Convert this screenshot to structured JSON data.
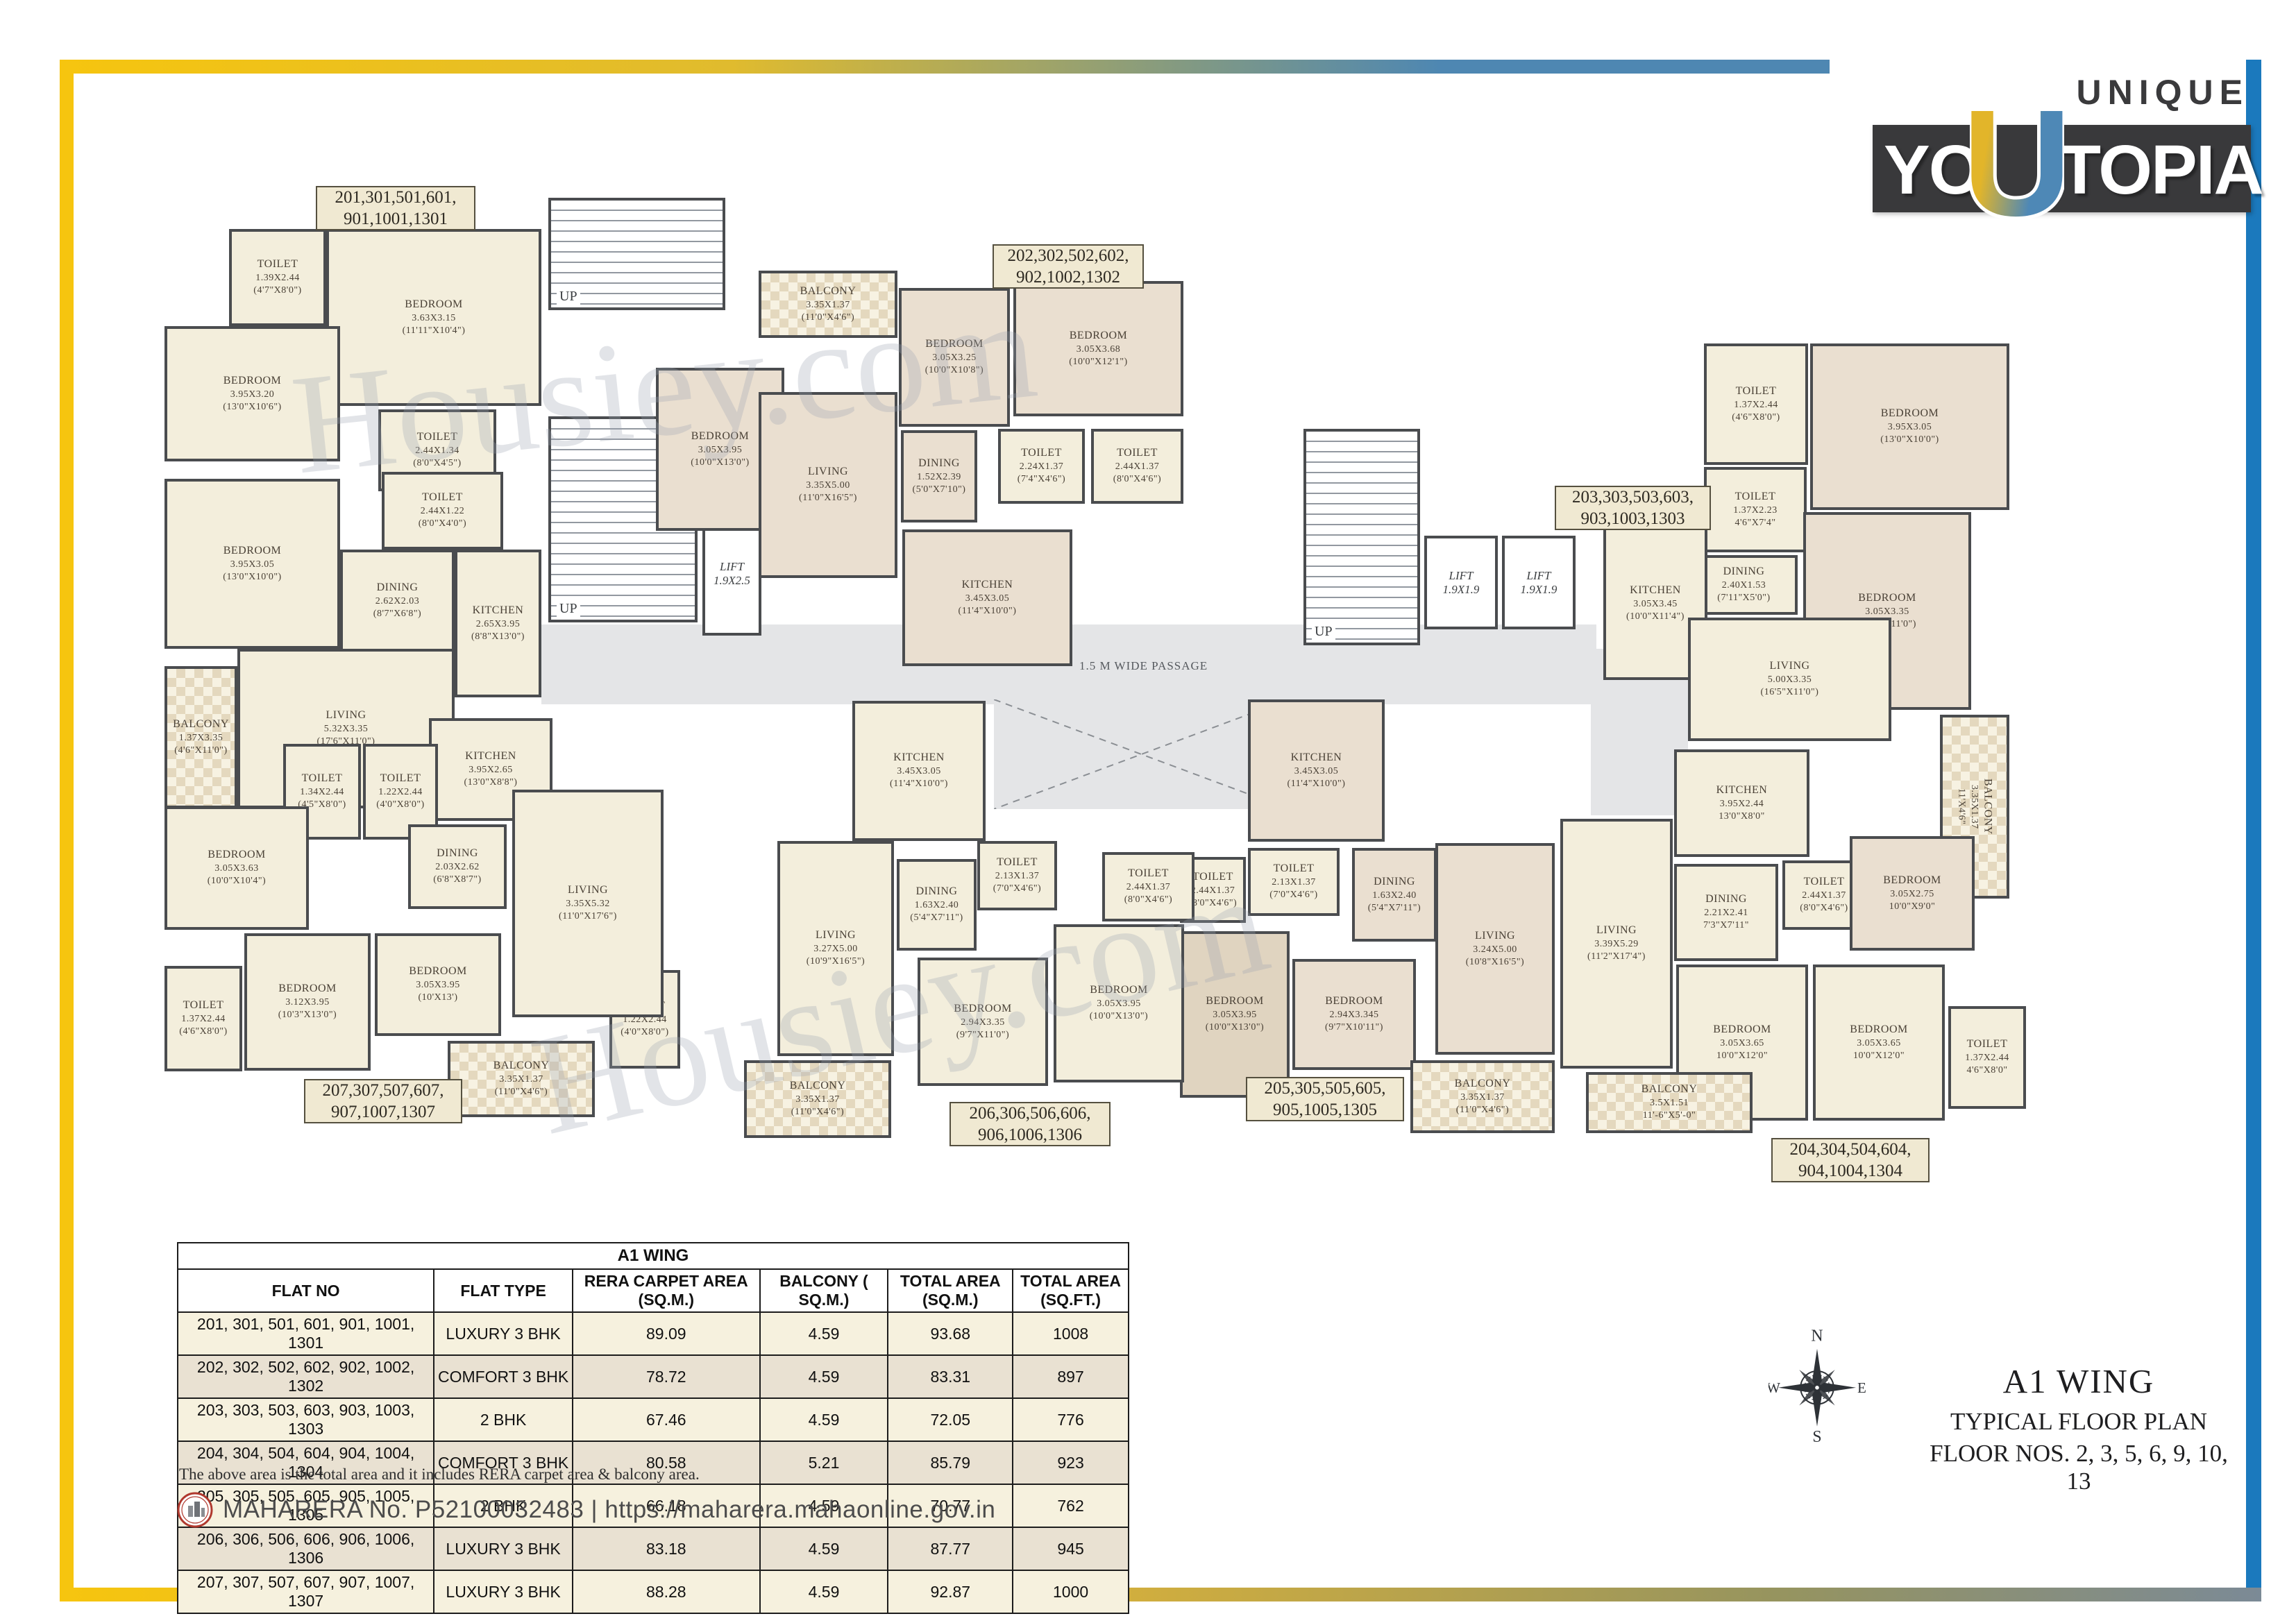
{
  "brand": {
    "unique": "UNIQUE",
    "yo": "YO",
    "u": "U",
    "topia": "TOPIA"
  },
  "plan": {
    "watermark": "Housiey.com",
    "passage": "1.5 M WIDE PASSAGE",
    "up": "UP",
    "lifts": [
      {
        "name": "LIFT",
        "size": "1.9X2.5"
      },
      {
        "name": "LIFT",
        "size": "1.9X1.9"
      },
      {
        "name": "LIFT",
        "size": "1.9X1.9"
      }
    ],
    "apts": [
      {
        "id": "201",
        "label": [
          "201,301,501,601,",
          "901,1001,1301"
        ],
        "rooms": [
          {
            "n": "TOILET",
            "m": "1.39X2.44",
            "f": "(4'7\"X8'0\")"
          },
          {
            "n": "BEDROOM",
            "m": "3.63X3.15",
            "f": "(11'11\"X10'4\")"
          },
          {
            "n": "BEDROOM",
            "m": "3.95X3.20",
            "f": "(13'0\"X10'6\")"
          },
          {
            "n": "TOILET",
            "m": "2.44X1.34",
            "f": "(8'0\"X4'5\")"
          },
          {
            "n": "TOILET",
            "m": "2.44X1.22",
            "f": "(8'0\"X4'0\")"
          },
          {
            "n": "BEDROOM",
            "m": "3.95X3.05",
            "f": "(13'0\"X10'0\")"
          },
          {
            "n": "DINING",
            "m": "2.62X2.03",
            "f": "(8'7\"X6'8\")"
          },
          {
            "n": "KITCHEN",
            "m": "2.65X3.95",
            "f": "(8'8\"X13'0\")"
          },
          {
            "n": "BALCONY",
            "m": "1.37X3.35",
            "f": "(4'6\"X11'0\")"
          },
          {
            "n": "LIVING",
            "m": "5.32X3.35",
            "f": "(17'6\"X11'0\")"
          }
        ]
      },
      {
        "id": "202",
        "label": [
          "202,302,502,602,",
          "902,1002,1302"
        ],
        "rooms": [
          {
            "n": "BALCONY",
            "m": "3.35X1.37",
            "f": "(11'0\"X4'6\")"
          },
          {
            "n": "BEDROOM",
            "m": "3.05X3.25",
            "f": "(10'0\"X10'8\")"
          },
          {
            "n": "BEDROOM",
            "m": "3.05X3.68",
            "f": "(10'0\"X12'1\")"
          },
          {
            "n": "BEDROOM",
            "m": "3.05X3.95",
            "f": "(10'0\"X13'0\")"
          },
          {
            "n": "LIVING",
            "m": "3.35X5.00",
            "f": "(11'0\"X16'5\")"
          },
          {
            "n": "DINING",
            "m": "1.52X2.39",
            "f": "(5'0\"X7'10\")"
          },
          {
            "n": "TOILET",
            "m": "2.24X1.37",
            "f": "(7'4\"X4'6\")"
          },
          {
            "n": "TOILET",
            "m": "2.44X1.37",
            "f": "(8'0\"X4'6\")"
          },
          {
            "n": "KITCHEN",
            "m": "3.45X3.05",
            "f": "(11'4\"X10'0\")"
          }
        ]
      },
      {
        "id": "203",
        "label": [
          "203,303,503,603,",
          "903,1003,1303"
        ],
        "rooms": [
          {
            "n": "TOILET",
            "m": "1.37X2.44",
            "f": "(4'6\"X8'0\")"
          },
          {
            "n": "BEDROOM",
            "m": "3.95X3.05",
            "f": "(13'0\"X10'0\")"
          },
          {
            "n": "TOILET",
            "m": "1.37X2.23",
            "f": "4'6\"X7'4\""
          },
          {
            "n": "BEDROOM",
            "m": "3.05X3.35",
            "f": "(10'0\"X11'0\")"
          },
          {
            "n": "DINING",
            "m": "2.40X1.53",
            "f": "(7'11\"X5'0\")"
          },
          {
            "n": "KITCHEN",
            "m": "3.05X3.45",
            "f": "(10'0\"X11'4\")"
          },
          {
            "n": "LIVING",
            "m": "5.00X3.35",
            "f": "(16'5\"X11'0\")"
          },
          {
            "n": "BALCONY",
            "m": "3.35X1.37",
            "f": "11'X4'6\""
          }
        ]
      },
      {
        "id": "204",
        "label": [
          "204,304,504,604,",
          "904,1004,1304"
        ],
        "rooms": [
          {
            "n": "KITCHEN",
            "m": "3.95X2.44",
            "f": "13'0\"X8'0\""
          },
          {
            "n": "DINING",
            "m": "2.21X2.41",
            "f": "7'3\"X7'11\""
          },
          {
            "n": "TOILET",
            "m": "2.44X1.37",
            "f": "(8'0\"X4'6\")"
          },
          {
            "n": "BEDROOM",
            "m": "3.05X2.75",
            "f": "10'0\"X9'0\""
          },
          {
            "n": "BEDROOM",
            "m": "3.05X3.65",
            "f": "10'0\"X12'0\""
          },
          {
            "n": "BEDROOM",
            "m": "3.05X3.65",
            "f": "10'0\"X12'0\""
          },
          {
            "n": "TOILET",
            "m": "1.37X2.44",
            "f": "4'6\"X8'0\""
          },
          {
            "n": "LIVING",
            "m": "3.39X5.29",
            "f": "(11'2\"X17'4\")"
          },
          {
            "n": "BALCONY",
            "m": "3.5X1.51",
            "f": "11'-6\"X5'-0\""
          }
        ]
      },
      {
        "id": "205",
        "label": [
          "205,305,505,605,",
          "905,1005,1305"
        ],
        "rooms": [
          {
            "n": "KITCHEN",
            "m": "3.45X3.05",
            "f": "(11'4\"X10'0\")"
          },
          {
            "n": "TOILET",
            "m": "2.13X1.37",
            "f": "(7'0\"X4'6\")"
          },
          {
            "n": "DINING",
            "m": "1.63X2.40",
            "f": "(5'4\"X7'11\")"
          },
          {
            "n": "LIVING",
            "m": "3.24X5.00",
            "f": "(10'8\"X16'5\")"
          },
          {
            "n": "BEDROOM",
            "m": "2.94X3.345",
            "f": "(9'7\"X10'11\")"
          },
          {
            "n": "TOILET",
            "m": "2.44X1.37",
            "f": "(8'0\"X4'6\")"
          },
          {
            "n": "BEDROOM",
            "m": "3.05X3.95",
            "f": "(10'0\"X13'0\")"
          },
          {
            "n": "BALCONY",
            "m": "3.35X1.37",
            "f": "(11'0\"X4'6\")"
          }
        ]
      },
      {
        "id": "206",
        "label": [
          "206,306,506,606,",
          "906,1006,1306"
        ],
        "rooms": [
          {
            "n": "KITCHEN",
            "m": "3.45X3.05",
            "f": "(11'4\"X10'0\")"
          },
          {
            "n": "LIVING",
            "m": "3.27X5.00",
            "f": "(10'9\"X16'5\")"
          },
          {
            "n": "DINING",
            "m": "1.63X2.40",
            "f": "(5'4\"X7'11\")"
          },
          {
            "n": "TOILET",
            "m": "2.13X1.37",
            "f": "(7'0\"X4'6\")"
          },
          {
            "n": "TOILET",
            "m": "2.44X1.37",
            "f": "(8'0\"X4'6\")"
          },
          {
            "n": "BEDROOM",
            "m": "3.05X3.95",
            "f": "(10'0\"X13'0\")"
          },
          {
            "n": "BEDROOM",
            "m": "2.94X3.35",
            "f": "(9'7\"X11'0\")"
          },
          {
            "n": "TOILET",
            "m": "1.22X2.44",
            "f": "(4'0\"X8'0\")"
          },
          {
            "n": "BALCONY",
            "m": "3.35X1.37",
            "f": "(11'0\"X4'6\")"
          }
        ]
      },
      {
        "id": "207",
        "label": [
          "207,307,507,607,",
          "907,1007,1307"
        ],
        "rooms": [
          {
            "n": "KITCHEN",
            "m": "3.95X2.65",
            "f": "(13'0\"X8'8\")"
          },
          {
            "n": "TOILET",
            "m": "1.34X2.44",
            "f": "(4'5\"X8'0\")"
          },
          {
            "n": "TOILET",
            "m": "1.22X2.44",
            "f": "(4'0\"X8'0\")"
          },
          {
            "n": "BEDROOM",
            "m": "3.05X3.63",
            "f": "(10'0\"X10'4\")"
          },
          {
            "n": "DINING",
            "m": "2.03X2.62",
            "f": "(6'8\"X8'7\")"
          },
          {
            "n": "LIVING",
            "m": "3.35X5.32",
            "f": "(11'0\"X17'6\")"
          },
          {
            "n": "TOILET",
            "m": "1.37X2.44",
            "f": "(4'6\"X8'0\")"
          },
          {
            "n": "BEDROOM",
            "m": "3.12X3.95",
            "f": "(10'3\"X13'0\")"
          },
          {
            "n": "BEDROOM",
            "m": "3.05X3.95",
            "f": "(10'X13')"
          },
          {
            "n": "BALCONY",
            "m": "3.35X1.37",
            "f": "(11'0\"X4'6\")"
          }
        ]
      }
    ]
  },
  "table": {
    "title": "A1 WING",
    "headers": [
      "FLAT NO",
      "FLAT TYPE",
      "RERA CARPET AREA (SQ.M.)",
      "BALCONY ( SQ.M.)",
      "TOTAL AREA (SQ.M.)",
      "TOTAL AREA (SQ.FT.)"
    ],
    "rows": [
      {
        "flats": "201, 301, 501, 601, 901, 1001, 1301",
        "type": "LUXURY 3 BHK",
        "carpet": "89.09",
        "balcony": "4.59",
        "sqm": "93.68",
        "sqft": "1008"
      },
      {
        "flats": "202, 302, 502, 602, 902, 1002, 1302",
        "type": "COMFORT 3 BHK",
        "carpet": "78.72",
        "balcony": "4.59",
        "sqm": "83.31",
        "sqft": "897"
      },
      {
        "flats": "203, 303, 503, 603, 903, 1003, 1303",
        "type": "2 BHK",
        "carpet": "67.46",
        "balcony": "4.59",
        "sqm": "72.05",
        "sqft": "776"
      },
      {
        "flats": "204, 304, 504, 604, 904, 1004, 1304",
        "type": "COMFORT 3 BHK",
        "carpet": "80.58",
        "balcony": "5.21",
        "sqm": "85.79",
        "sqft": "923"
      },
      {
        "flats": "205, 305, 505, 605, 905, 1005, 1305",
        "type": "2 BHK",
        "carpet": "66.18",
        "balcony": "4.59",
        "sqm": "70.77",
        "sqft": "762"
      },
      {
        "flats": "206, 306, 506, 606, 906, 1006, 1306",
        "type": "LUXURY 3 BHK",
        "carpet": "83.18",
        "balcony": "4.59",
        "sqm": "87.77",
        "sqft": "945"
      },
      {
        "flats": "207, 307, 507, 607, 907, 1007, 1307",
        "type": "LUXURY 3 BHK",
        "carpet": "88.28",
        "balcony": "4.59",
        "sqm": "92.87",
        "sqft": "1000"
      }
    ],
    "note": "The above area is the total area and it includes RERA carpet area & balcony area."
  },
  "footer": {
    "rera": "MAHARERA No. P52100032483 | https://maharera.mahaonline.gov.in"
  },
  "compass": {
    "n": "N",
    "e": "E",
    "s": "S",
    "w": "W"
  },
  "titleblock": {
    "wing": "A1 WING",
    "line2": "TYPICAL FLOOR PLAN",
    "line3": "FLOOR NOS. 2, 3, 5, 6, 9, 10, 13"
  },
  "colors": {
    "accent_yellow": "#F6C50F",
    "accent_blue": "#1B79BD",
    "wall": "#45474A",
    "room_cream": "#F3EEDC",
    "room_tan": "#EADFD0",
    "passage_gray": "#E4E5E7",
    "logo_dark": "#39393B"
  }
}
